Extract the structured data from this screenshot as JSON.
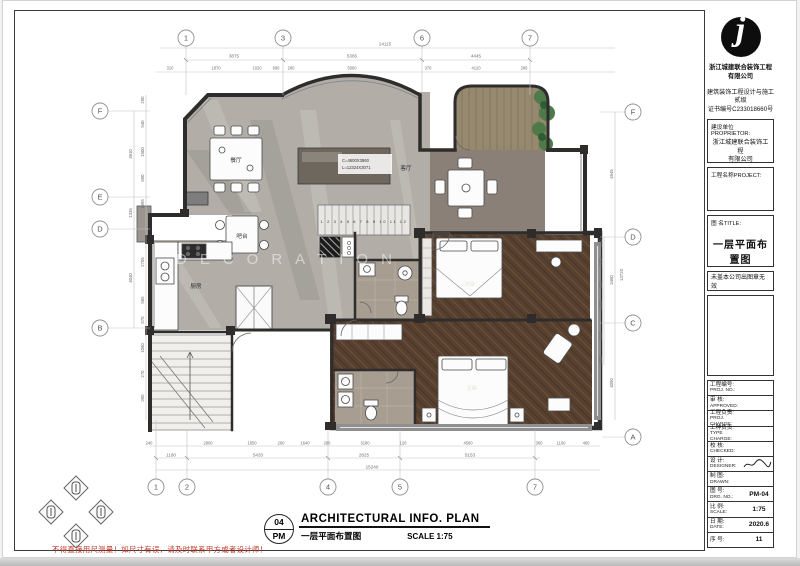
{
  "company": {
    "name_l1": "浙江城建联合装饰工程",
    "name_l2": "有限公司",
    "cert_l1": "建筑装饰工程设计与施工",
    "cert_l2": "贰级",
    "cert_l3": "证书编号C233018660号",
    "logo_letter": "j"
  },
  "title_block": {
    "proprietor_label": "建设单位PROPRIETOR:",
    "proprietor_l1": "浙江城建联合装饰工程",
    "proprietor_l2": "有限公司",
    "project_label": "工程名称PROJECT:",
    "title_label": "图  名TITLE:",
    "drawing_title": "一层平面布置图",
    "seal_note": "未盖本公司出图章无效",
    "rows": [
      {
        "cn": "工程编号:",
        "en": "PROJ. NO.:",
        "value": ""
      },
      {
        "cn": "审 核:",
        "en": "APPROVED:",
        "value": ""
      },
      {
        "cn": "工程负责:",
        "en": "PROJ. CHARGE:",
        "value": ""
      },
      {
        "cn": "工种负责:",
        "en": "TYPE CHARGE:",
        "value": ""
      },
      {
        "cn": "校 核:",
        "en": "CHECKED:",
        "value": ""
      },
      {
        "cn": "设 计:",
        "en": "DESIGNER:",
        "value": ""
      },
      {
        "cn": "制 图:",
        "en": "DRAWN:",
        "value": ""
      },
      {
        "cn": "图 号:",
        "en": "DRG. NO.:",
        "value": "PM-04"
      },
      {
        "cn": "比 例:",
        "en": "SCALE:",
        "value": "1:75"
      },
      {
        "cn": "日 期:",
        "en": "DATE:",
        "value": "2020.6"
      },
      {
        "cn": "序 号:",
        "en": "",
        "value": "11"
      }
    ]
  },
  "footer": {
    "fig_no_top": "04",
    "fig_no_bottom": "PM",
    "title_en": "ARCHITECTURAL  INFO.  PLAN",
    "title_cn": "一层平面布置图",
    "scale_label": "SCALE 1:75",
    "warning": "不得直接用尺测量！如尺寸有误，请及时联系甲方或者设计师！"
  },
  "plan": {
    "watermark": "AN  DECORATION",
    "rooms": {
      "dining": "餐厅",
      "kitchen": "厨房",
      "bar": "吧台",
      "living": "客厅",
      "bedroom2": "次卧",
      "master": "主卧"
    },
    "living_note_l1": "C=4600X3960",
    "living_note_l2": "L=12324X3071",
    "stair_numbers": "1 2 3 4 5 6 7 8 9 10 11 12",
    "grid": {
      "top": [
        "1",
        "3",
        "6",
        "7"
      ],
      "bottom": [
        "1",
        "2",
        "4",
        "5",
        "7"
      ],
      "left": [
        "F",
        "E",
        "D",
        "B"
      ],
      "right": [
        "F",
        "D",
        "C",
        "A"
      ]
    },
    "dims": {
      "top_overall": "14115",
      "top_mid": [
        "3875",
        "5365",
        "4445"
      ],
      "top_detail": [
        "310",
        "1870",
        "1020",
        "690",
        "280",
        "5060",
        "370",
        "4120",
        "280"
      ],
      "bottom_overall": "15240",
      "bottom_mid": [
        "1160",
        "5433",
        "2825",
        "5153"
      ],
      "bottom_detail": [
        "240",
        "2800",
        "1850",
        "260",
        "1640",
        "280",
        "3180",
        "120",
        "4500",
        "360",
        "1160",
        "460"
      ],
      "left_outer": [
        "3610",
        "1335",
        "4040"
      ],
      "left_detail": [
        "290",
        "940",
        "1500",
        "690",
        "1395",
        "2705",
        "565",
        "570",
        "1060",
        "270",
        "390"
      ],
      "right_outer": [
        "4945",
        "3460",
        "4090"
      ],
      "right_overall": "13720",
      "right_detail": [
        "240",
        "870",
        "810",
        "1503",
        "847",
        "460"
      ]
    }
  },
  "colors": {
    "wall": "#2e2d2b",
    "marble": "#b2aea7",
    "marble_dark": "#8b8078",
    "wood_bedroom": "#57402f",
    "wood_bedroom_line": "#6b5138",
    "wood_balcony": "#96896f",
    "bath_tile": "#a79d90",
    "plant": "#4e7a49",
    "warning_red": "#c23a2b"
  }
}
